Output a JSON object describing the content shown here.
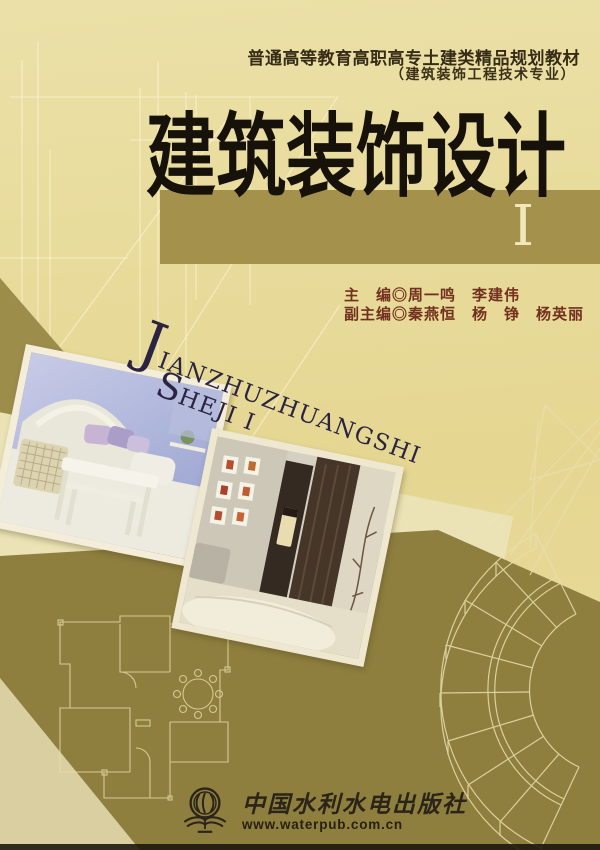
{
  "cover": {
    "series": {
      "line1": "普通高等教育高职高专土建类精品规划教材",
      "line2": "（建筑装饰工程技术专业）"
    },
    "title": "建筑装饰设计",
    "volume_numeral": "I",
    "editors": {
      "line1": "主　编◎周一鸣　李建伟",
      "line2": "副主编◎秦燕恒　杨　铮　杨英丽"
    },
    "pinyin": {
      "line1_initial": "J",
      "line1_rest": "IANZHUZHUANGSHI",
      "line2_initial": "S",
      "line2_rest": "HEJI I"
    },
    "publisher": {
      "name": "中国水利水电出版社",
      "website": "www.waterpub.com.cn"
    },
    "colors": {
      "background": "#e8db9c",
      "title_band": "#a3914c",
      "bottom_panel": "#8e7f3e",
      "diagonal_strip": "#ebe3b6",
      "title_text": "#16120a",
      "editor_text": "#72301e",
      "pinyin_text": "#2a2442",
      "numeral_text": "#f1e7bb",
      "logo_text": "#2b2418"
    }
  }
}
